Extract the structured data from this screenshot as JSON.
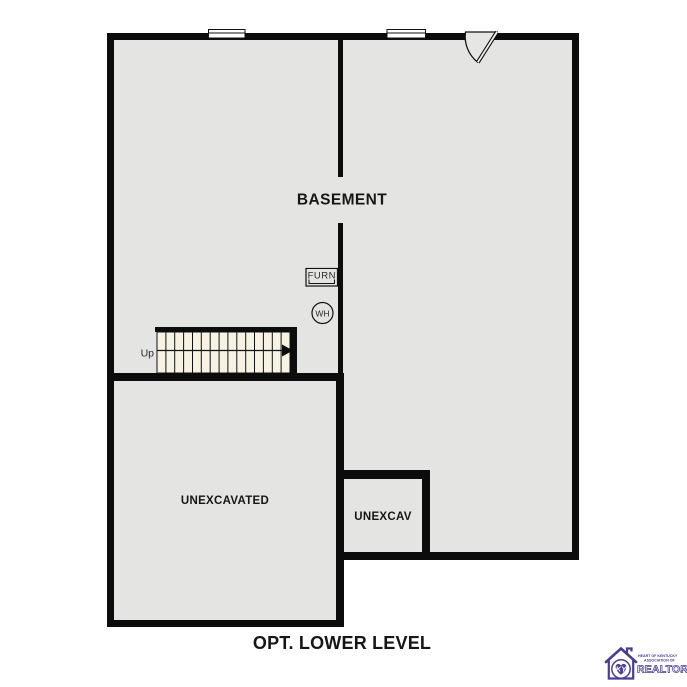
{
  "title": "OPT. LOWER LEVEL",
  "rooms": {
    "basement": "BASEMENT",
    "unexcavated": "UNEXCAVATED",
    "unexcav": "UNEXCAV"
  },
  "labels": {
    "up": "Up",
    "furnace": "FURN",
    "water_heater": "WH"
  },
  "stairs": {
    "direction": "Up",
    "tread_count": 15
  },
  "logo": {
    "org_line1": "HEART OF KENTUCKY",
    "org_line2": "ASSOCIATION OF",
    "org_line3": "REALTORS",
    "registered": "®",
    "monogram": "KY",
    "color": "#4a3d91"
  },
  "colors": {
    "wall": "#0c0c0c",
    "floor": "#e4e4e2",
    "stairs_fill": "#f7f2e4",
    "background": "#ffffff",
    "text": "#161616"
  }
}
